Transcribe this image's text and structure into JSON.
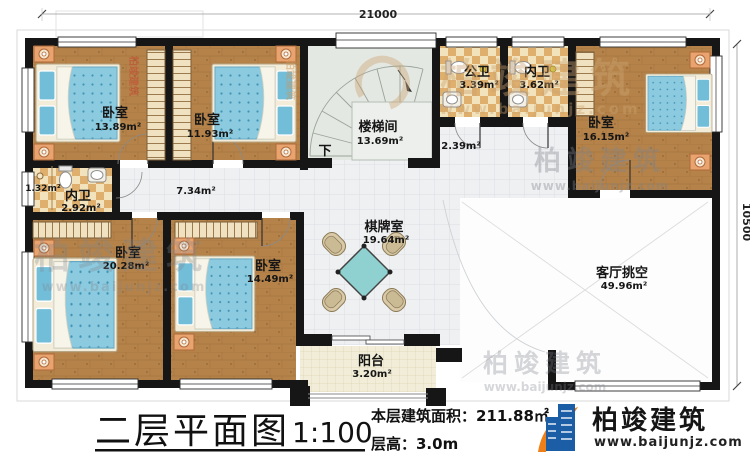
{
  "plan": {
    "title": "二层平面图",
    "scale": "1:100",
    "area_label": "本层建筑面积：211.88㎡",
    "floor_height_label": "层高：3.0m",
    "dim_top": "21000",
    "dim_right": "10500",
    "down_label": "下"
  },
  "brand": {
    "name": "柏竣建筑",
    "url": "www.baijunjz.com"
  },
  "rooms": {
    "bedroom1": {
      "name": "卧室",
      "area": "13.89m²"
    },
    "bedroom2": {
      "name": "卧室",
      "area": "11.93m²"
    },
    "stairwell": {
      "name": "楼梯间",
      "area": "13.69m²"
    },
    "public_bath": {
      "name": "公卫",
      "area": "3.39m²"
    },
    "inner_bath_top": {
      "name": "内卫",
      "area": "3.62m²"
    },
    "bedroom3": {
      "name": "卧室",
      "area": "16.15m²"
    },
    "inner_bath_left": {
      "name": "内卫",
      "area": "2.92m²"
    },
    "closet": {
      "area": "1.32m²"
    },
    "hall": {
      "area": "7.34m²"
    },
    "hall2": {
      "area": "2.39m²"
    },
    "bedroom4": {
      "name": "卧室",
      "area": "20.28m²"
    },
    "bedroom5": {
      "name": "卧室",
      "area": "14.49m²"
    },
    "game_room": {
      "name": "棋牌室",
      "area": "19.64m²"
    },
    "balcony": {
      "name": "阳台",
      "area": "3.20m²"
    },
    "living_void": {
      "name": "客厅挑空",
      "area": "49.96m²"
    }
  },
  "palette": {
    "wall": "#161616",
    "wood": "#b5834a",
    "bed_blue": "#8ccadf",
    "bath_tile": "#e2b36f",
    "tile_light": "#eff0f2",
    "balcony_tile": "#f1edd8",
    "stair_floor": "#e4e8e2",
    "brand_blue": "#1b5ea6",
    "brand_orange": "#ee8019"
  }
}
